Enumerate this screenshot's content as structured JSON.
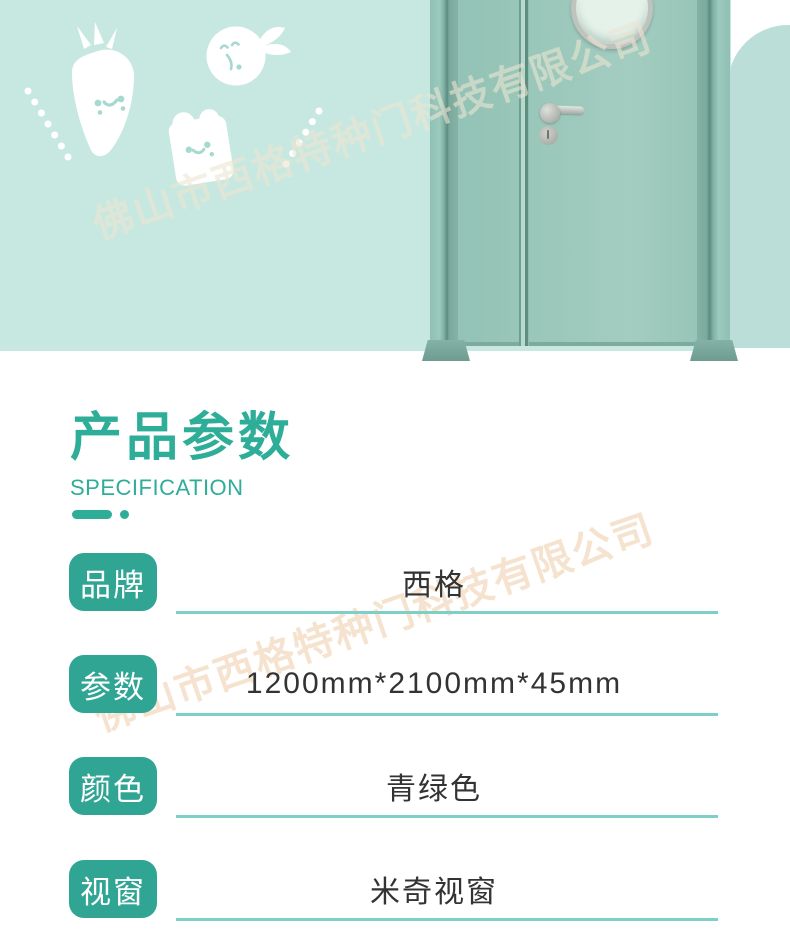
{
  "watermark": {
    "text": "佛山市西格特种门科技有限公司"
  },
  "section": {
    "title": "产品参数",
    "subtitle": "SPECIFICATION"
  },
  "specs": [
    {
      "label": "品牌",
      "value": "西格"
    },
    {
      "label": "参数",
      "value": "1200mm*2100mm*45mm"
    },
    {
      "label": "颜色",
      "value": "青绿色"
    },
    {
      "label": "视窗",
      "value": "米奇视窗"
    }
  ],
  "illustrations": [
    "carrot-icon",
    "orange-icon",
    "bread-icon",
    "dots-decoration"
  ],
  "colors": {
    "accent_teal": "#2ead98",
    "badge_teal": "#30a593",
    "underline_teal": "#7ed0c6",
    "hero_background": "#c7e8e1",
    "arch_shape": "#bbdfd8",
    "door_leaf": "#9bc8bb",
    "door_frame_dark": "#5e8d80",
    "value_text": "#333333",
    "watermark_top": "#ece5d2",
    "watermark_bottom": "#f4dfc7"
  }
}
